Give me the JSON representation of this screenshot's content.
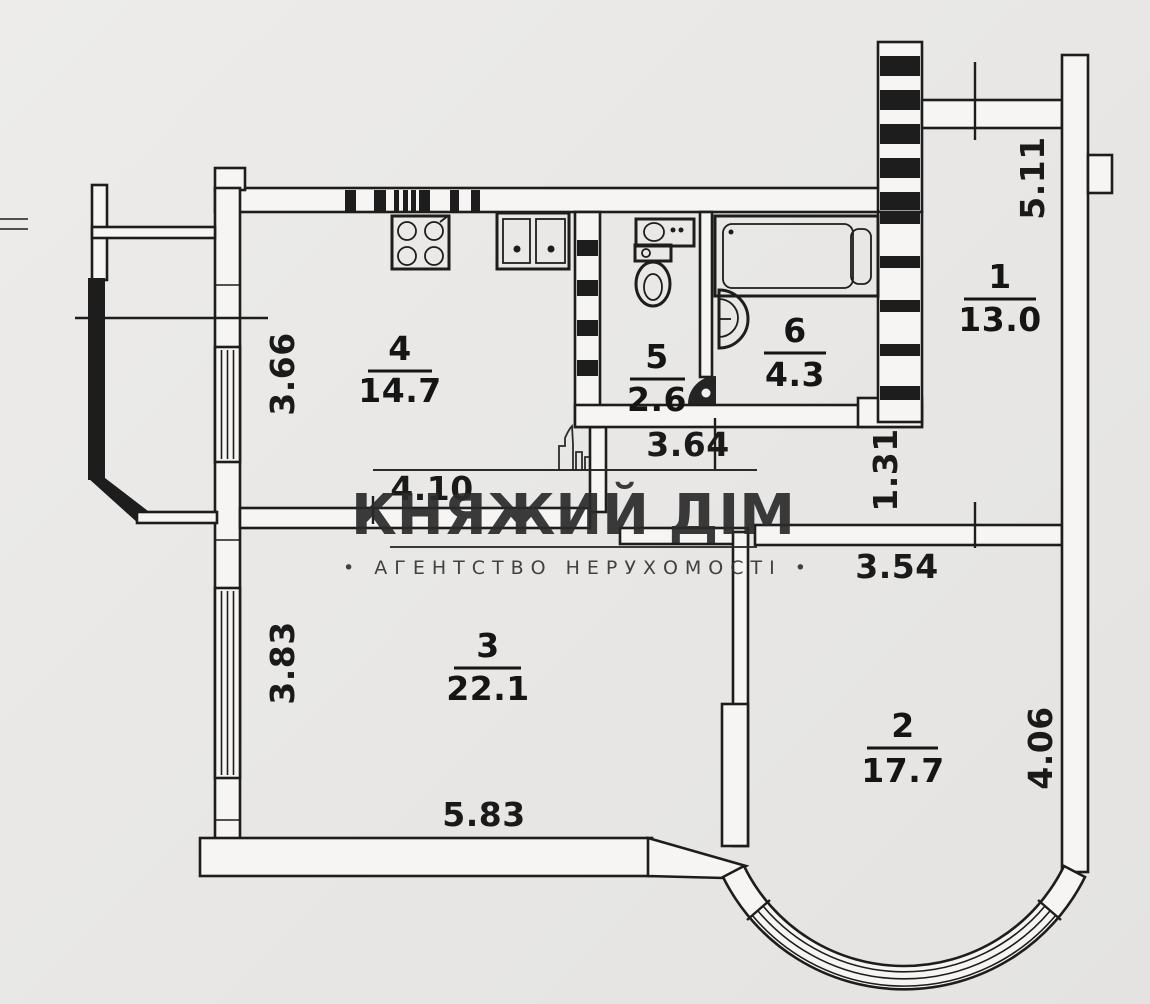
{
  "brand": {
    "name": "КНЯЖИЙ ДІМ",
    "tagline": "• АГЕНТСТВО  НЕРУХОМОСТІ •",
    "ink_color": "#2b2b2b"
  },
  "plan": {
    "type": "apartment-floor-plan",
    "paper_color": "#e9e8e6",
    "ink_color": "#1d1d1d",
    "rooms": {
      "r1": {
        "number": "1",
        "area": "13.0"
      },
      "r2": {
        "number": "2",
        "area": "17.7"
      },
      "r3": {
        "number": "3",
        "area": "22.1"
      },
      "r4": {
        "number": "4",
        "area": "14.7"
      },
      "r5": {
        "number": "5",
        "area": "2.6"
      },
      "r6": {
        "number": "6",
        "area": "4.3"
      }
    },
    "dimensions": {
      "balcony_left_height": "3.66",
      "hall_width": "4.10",
      "sanitary_block_width": "3.64",
      "corridor_height": "1.31",
      "loggia_right_height": "5.11",
      "room2_width_top": "3.54",
      "room3_window_height": "3.83",
      "room3_width": "5.83",
      "room2_height_right": "4.06"
    },
    "fixtures": [
      "stove-icon",
      "kitchen-sink-icon",
      "washbasin-icon",
      "toilet-icon",
      "door-swing-icon",
      "bathtub-icon",
      "bath-washbasin-icon"
    ]
  }
}
